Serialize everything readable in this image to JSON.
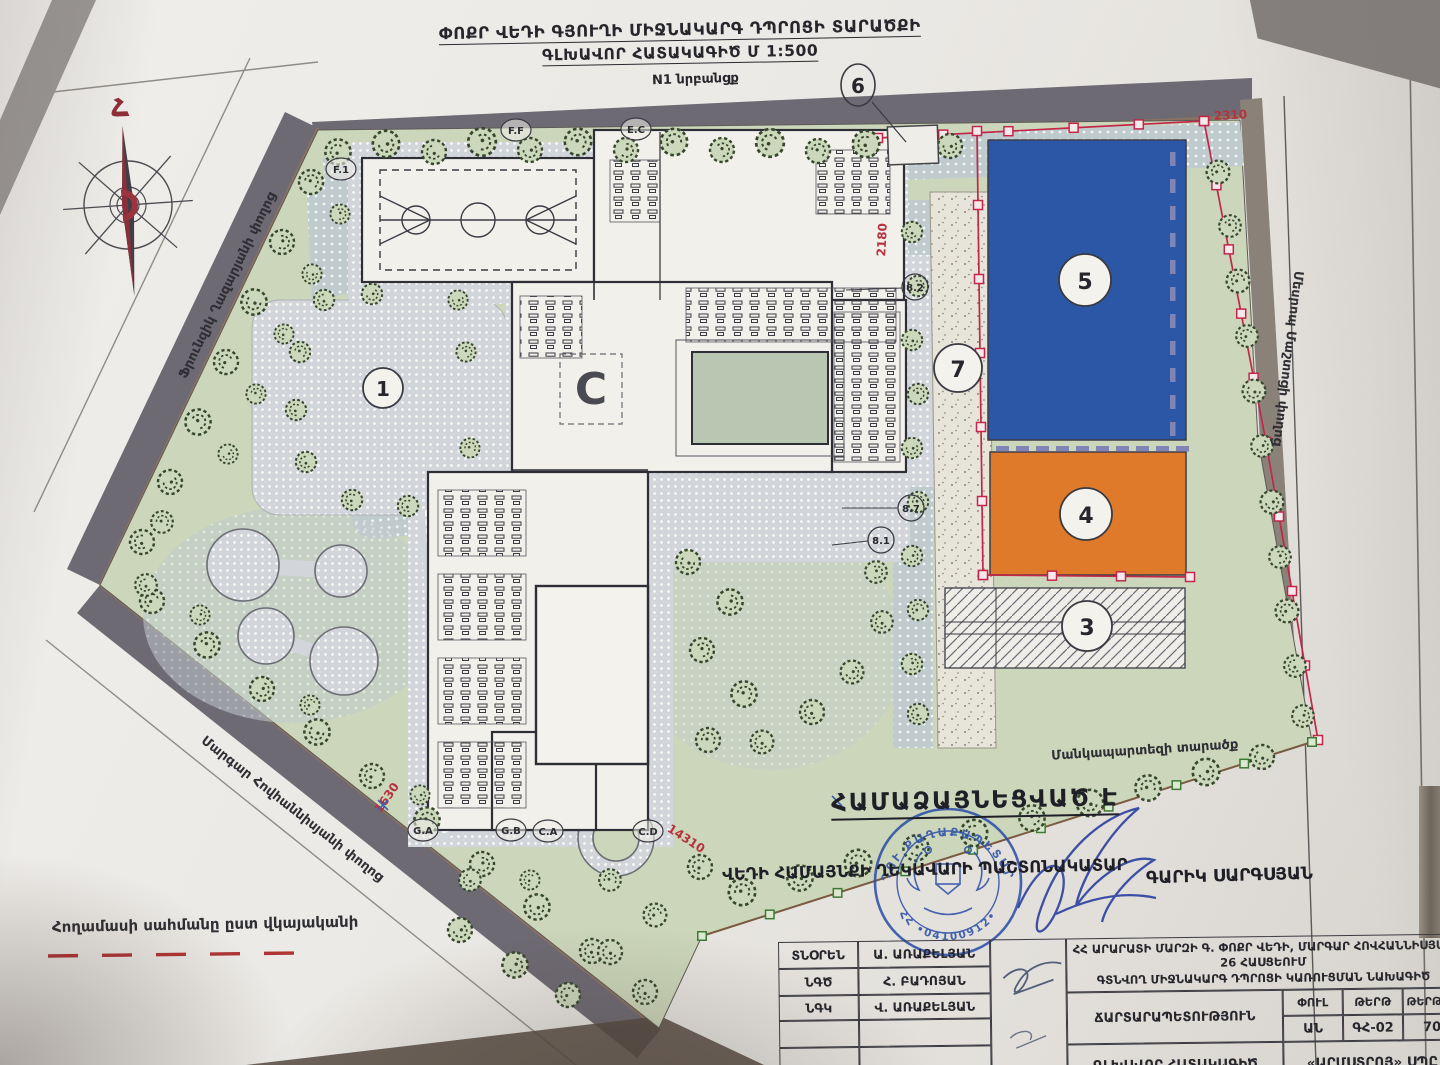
{
  "title": {
    "line1": "ՓՈՔՐ ՎԵԴԻ ԳՅՈՒՂԻ ՄԻՋՆԱԿԱՐԳ ԴՊՐՈՑԻ ՏԱՐԱԾՔԻ",
    "line2": "ԳԼԽԱՎՈՐ ՀԱՏԱԿԱԳԻԾ  Մ 1:500"
  },
  "plan": {
    "streets": {
      "top": "N1 նրբանցք",
      "left_upper": "Ֆրունզիկ Ղազարյանի փողոց",
      "left_lower": "Մարգար Հովհաննիսյանի փողոց",
      "right": "Մեսրոպ Մաշտոցի փողոց"
    },
    "labels": {
      "kindergarten": "Մանկապարտեզի տարածք",
      "legend_boundary": "Հողամասի սահմանը ըստ վկայականի",
      "north": "Հ",
      "logo": "C"
    },
    "callouts": {
      "c1": "1",
      "c3": "3",
      "c4": "4",
      "c5": "5",
      "c6": "6",
      "c7": "7",
      "s1": "8.2",
      "s2": "8.7",
      "s3": "8.1",
      "t1": "F.1",
      "t2": "F.F",
      "t3": "E.C",
      "t4": "G.A",
      "t5": "G.B",
      "t6": "C.A",
      "t7": "C.D"
    },
    "dimensions": {
      "top": "2310",
      "left": "2180",
      "west": "1630",
      "bottom": "14310"
    }
  },
  "approval": {
    "heading": "ՀԱՄԱՁԱՅՆԵՑՎԱԾ Է",
    "line": "ՎԵԴԻ ՀԱՄԱՅՆՔԻ ՂԵԿԱՎԱՐԻ ՊԱՇՏՈՆԱԿԱՏԱՐ",
    "name": "ԳԱՐԻԿ ՍԱՐԳՍՅԱՆ",
    "stamp_top": "ՎԵԴՈՒ ՔԱՂԱՔԱՊԵՏԱՐԱՆ",
    "stamp_bottom": "ՀՀ  •04100912•"
  },
  "titleblock": {
    "rows": [
      {
        "role": "ՏՆՕՐԵՆ",
        "name": "Ա. ԱՌԱՔԵԼՅԱՆ"
      },
      {
        "role": "ՆԳԾ",
        "name": "Հ. ԲԱԴՈՅԱՆ"
      },
      {
        "role": "ՆԳԿ",
        "name": "Վ. ԱՌԱՔԵԼՅԱՆ"
      }
    ],
    "project_line1": "ՀՀ ԱՐԱՐԱՏԻ ՄԱՐԶԻ Գ. ՓՈՔՐ ՎԵԴԻ, ՄԱՐԳԱՐ ՀՈՎՀԱՆՆԻՍՅԱՆ 26 ՀԱՍՑԵՈՒՄ",
    "project_line2": "ԳՏՆՎՈՂ ՄԻՋՆԱԿԱՐԳ ԴՊՐՈՑԻ ԿԱՌՈՒՑՄԱՆ ՆԱԽԱԳԻԾ",
    "discipline": "ՃԱՐՏԱՐԱՊԵՏՈՒԹՅՈՒՆ",
    "phase_label": "ՓՈՒԼ",
    "sheet_label": "ԹԵՐԹ",
    "sheets_label": "ԹԵՐԹԵՐ",
    "phase": "ԱՆ",
    "sheet": "ԳՀ-02",
    "sheets": "70",
    "drawing": "ԳԼԽԱՎՈՐ ՀԱՏԱԿԱԳԻԾ",
    "company": "«ԱՐՄՍՏՐՈՅ» ՍՊԸ"
  },
  "colors": {
    "field_blue": "#2b57a6",
    "field_orange": "#df7a2b",
    "boundary_red": "#c2274a",
    "marker_green": "#3e7a33",
    "stamp_blue": "#2d50a8",
    "lawn": "#ccd6ba",
    "street_dark": "#6e6a73"
  }
}
